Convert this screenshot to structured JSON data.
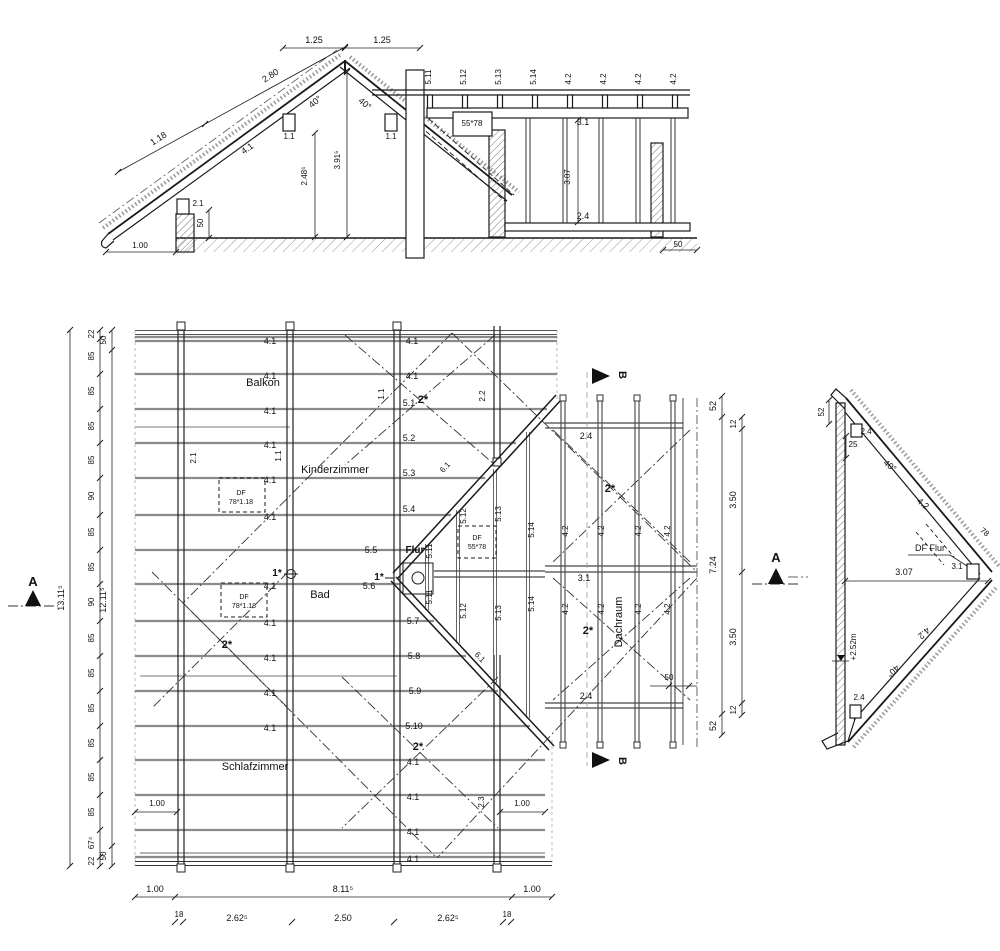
{
  "colors": {
    "line": "#1a1a1a",
    "rafter": "#8a8a8a",
    "dim": "#222",
    "light": "#c4c4c4",
    "marker": "#111"
  },
  "labels": [
    {
      "t": "1.25",
      "x": 314,
      "y": 43
    },
    {
      "t": "1.25",
      "x": 382,
      "y": 43
    },
    {
      "t": "2.80",
      "x": 272,
      "y": 78,
      "r": -33
    },
    {
      "t": "1.18",
      "x": 160,
      "y": 141,
      "r": -33
    },
    {
      "t": "4.1",
      "x": 249,
      "y": 151,
      "r": -36
    },
    {
      "t": "40°",
      "x": 317,
      "y": 104,
      "r": -40
    },
    {
      "t": "40°",
      "x": 363,
      "y": 106,
      "r": 40
    },
    {
      "t": "1.1",
      "x": 289,
      "y": 139,
      "s": 8
    },
    {
      "t": "1.1",
      "x": 391,
      "y": 139,
      "s": 8
    },
    {
      "t": "3.91⁵",
      "x": 340,
      "y": 160,
      "r": -90,
      "s": 8
    },
    {
      "t": "2.48⁵",
      "x": 307,
      "y": 176,
      "r": -90,
      "s": 8
    },
    {
      "t": "2.1",
      "x": 198,
      "y": 206,
      "s": 8
    },
    {
      "t": "50",
      "x": 203,
      "y": 223,
      "r": -90,
      "s": 8
    },
    {
      "t": "1.00",
      "x": 140,
      "y": 248,
      "s": 8
    },
    {
      "t": "5.11",
      "x": 431,
      "y": 77,
      "r": -90,
      "s": 8
    },
    {
      "t": "5.12",
      "x": 466,
      "y": 77,
      "r": -90,
      "s": 8
    },
    {
      "t": "5.13",
      "x": 501,
      "y": 77,
      "r": -90,
      "s": 8
    },
    {
      "t": "5.14",
      "x": 536,
      "y": 77,
      "r": -90,
      "s": 8
    },
    {
      "t": "4.2",
      "x": 571,
      "y": 79,
      "r": -90,
      "s": 8
    },
    {
      "t": "4.2",
      "x": 606,
      "y": 79,
      "r": -90,
      "s": 8
    },
    {
      "t": "4.2",
      "x": 641,
      "y": 79,
      "r": -90,
      "s": 8
    },
    {
      "t": "4.2",
      "x": 676,
      "y": 79,
      "r": -90,
      "s": 8
    },
    {
      "t": "55*78",
      "x": 472,
      "y": 126,
      "s": 8
    },
    {
      "t": "3.1",
      "x": 583,
      "y": 125,
      "s": 9
    },
    {
      "t": "3.07",
      "x": 570,
      "y": 177,
      "r": -90,
      "s": 8
    },
    {
      "t": "2.4",
      "x": 583,
      "y": 219,
      "s": 9
    },
    {
      "t": "50",
      "x": 678,
      "y": 247,
      "s": 8
    },
    {
      "t": "Balkon",
      "x": 263,
      "y": 386,
      "s": 11
    },
    {
      "t": "Kinderzimmer",
      "x": 335,
      "y": 473,
      "s": 11
    },
    {
      "t": "Bad",
      "x": 320,
      "y": 598,
      "s": 11
    },
    {
      "t": "Flur",
      "x": 415,
      "y": 553,
      "s": 10,
      "b": 1
    },
    {
      "t": "Schlafzimmer",
      "x": 255,
      "y": 770,
      "s": 11
    },
    {
      "t": "Dachraum",
      "x": 622,
      "y": 622,
      "r": -90,
      "s": 11
    },
    {
      "t": "4.1",
      "x": 270,
      "y": 344,
      "s": 9
    },
    {
      "t": "4.1",
      "x": 270,
      "y": 379,
      "s": 9
    },
    {
      "t": "4.1",
      "x": 270,
      "y": 414,
      "s": 9
    },
    {
      "t": "4.1",
      "x": 270,
      "y": 448,
      "s": 9
    },
    {
      "t": "4.1",
      "x": 270,
      "y": 483,
      "s": 9
    },
    {
      "t": "4.1",
      "x": 270,
      "y": 520,
      "s": 9
    },
    {
      "t": "4.1",
      "x": 270,
      "y": 589,
      "s": 9
    },
    {
      "t": "4.1",
      "x": 270,
      "y": 626,
      "s": 9
    },
    {
      "t": "4.1",
      "x": 270,
      "y": 661,
      "s": 9
    },
    {
      "t": "4.1",
      "x": 270,
      "y": 696,
      "s": 9
    },
    {
      "t": "4.1",
      "x": 270,
      "y": 731,
      "s": 9
    },
    {
      "t": "4.1",
      "x": 412,
      "y": 344,
      "s": 9
    },
    {
      "t": "4.1",
      "x": 412,
      "y": 379,
      "s": 9
    },
    {
      "t": "4.1",
      "x": 413,
      "y": 765,
      "s": 9
    },
    {
      "t": "4.1",
      "x": 413,
      "y": 800,
      "s": 9
    },
    {
      "t": "4.1",
      "x": 413,
      "y": 835,
      "s": 9
    },
    {
      "t": "4.1",
      "x": 413,
      "y": 862,
      "s": 9
    },
    {
      "t": "5.1",
      "x": 409,
      "y": 406,
      "s": 9
    },
    {
      "t": "5.2",
      "x": 409,
      "y": 441,
      "s": 9
    },
    {
      "t": "5.3",
      "x": 409,
      "y": 476,
      "s": 9
    },
    {
      "t": "5.4",
      "x": 409,
      "y": 512,
      "s": 9
    },
    {
      "t": "5.5",
      "x": 371,
      "y": 553,
      "s": 9
    },
    {
      "t": "5.6",
      "x": 369,
      "y": 589,
      "s": 9
    },
    {
      "t": "5.7",
      "x": 413,
      "y": 624,
      "s": 9
    },
    {
      "t": "5.8",
      "x": 414,
      "y": 659,
      "s": 9
    },
    {
      "t": "5.9",
      "x": 415,
      "y": 694,
      "s": 9
    },
    {
      "t": "5.10",
      "x": 414,
      "y": 729,
      "s": 9
    },
    {
      "t": "1*",
      "x": 277,
      "y": 576,
      "s": 10,
      "b": 1
    },
    {
      "t": "1*",
      "x": 379,
      "y": 580,
      "s": 10,
      "b": 1
    },
    {
      "t": "2*",
      "x": 423,
      "y": 403,
      "s": 11,
      "b": 1
    },
    {
      "t": "2*",
      "x": 227,
      "y": 648,
      "s": 11,
      "b": 1
    },
    {
      "t": "2*",
      "x": 418,
      "y": 750,
      "s": 11,
      "b": 1
    },
    {
      "t": "2*",
      "x": 610,
      "y": 492,
      "s": 11,
      "b": 1
    },
    {
      "t": "2*",
      "x": 588,
      "y": 634,
      "s": 11,
      "b": 1
    },
    {
      "t": "2.1",
      "x": 196,
      "y": 458,
      "r": -90,
      "s": 8
    },
    {
      "t": "1.1",
      "x": 281,
      "y": 456,
      "r": -90,
      "s": 8
    },
    {
      "t": "1.1",
      "x": 384,
      "y": 394,
      "r": -90,
      "s": 8
    },
    {
      "t": "2.2",
      "x": 485,
      "y": 396,
      "r": -90,
      "s": 8
    },
    {
      "t": "2.3",
      "x": 484,
      "y": 802,
      "r": -90,
      "s": 8
    },
    {
      "t": "6.1",
      "x": 447,
      "y": 469,
      "r": -48,
      "s": 8
    },
    {
      "t": "6.1",
      "x": 478,
      "y": 659,
      "r": 47,
      "s": 8
    },
    {
      "t": "5.11",
      "x": 432,
      "y": 551,
      "r": -90,
      "s": 8
    },
    {
      "t": "5.11",
      "x": 432,
      "y": 597,
      "r": -90,
      "s": 8
    },
    {
      "t": "5.12",
      "x": 466,
      "y": 516,
      "r": -90,
      "s": 8
    },
    {
      "t": "5.12",
      "x": 466,
      "y": 611,
      "r": -90,
      "s": 8
    },
    {
      "t": "5.13",
      "x": 501,
      "y": 514,
      "r": -90,
      "s": 8
    },
    {
      "t": "5.13",
      "x": 501,
      "y": 613,
      "r": -90,
      "s": 8
    },
    {
      "t": "5.14",
      "x": 534,
      "y": 530,
      "r": -90,
      "s": 8
    },
    {
      "t": "5.14",
      "x": 534,
      "y": 604,
      "r": -90,
      "s": 8
    },
    {
      "t": "DF",
      "x": 241,
      "y": 495,
      "s": 7
    },
    {
      "t": "78*1.18",
      "x": 241,
      "y": 504,
      "s": 7
    },
    {
      "t": "DF",
      "x": 244,
      "y": 599,
      "s": 7
    },
    {
      "t": "78*1.18",
      "x": 244,
      "y": 608,
      "s": 7
    },
    {
      "t": "DF",
      "x": 477,
      "y": 540,
      "s": 7
    },
    {
      "t": "55*78",
      "x": 477,
      "y": 549,
      "s": 7
    },
    {
      "t": "2.4",
      "x": 586,
      "y": 439,
      "s": 9
    },
    {
      "t": "3.1",
      "x": 584,
      "y": 581,
      "s": 9
    },
    {
      "t": "2.4",
      "x": 586,
      "y": 699,
      "s": 9
    },
    {
      "t": "4.2",
      "x": 568,
      "y": 531,
      "r": -90,
      "s": 8
    },
    {
      "t": "4.2",
      "x": 604,
      "y": 531,
      "r": -90,
      "s": 8
    },
    {
      "t": "4.2",
      "x": 641,
      "y": 531,
      "r": -90,
      "s": 8
    },
    {
      "t": "4.2",
      "x": 670,
      "y": 531,
      "r": -90,
      "s": 8
    },
    {
      "t": "4.2",
      "x": 568,
      "y": 609,
      "r": -90,
      "s": 8
    },
    {
      "t": "4.2",
      "x": 604,
      "y": 609,
      "r": -90,
      "s": 8
    },
    {
      "t": "4.2",
      "x": 641,
      "y": 609,
      "r": -90,
      "s": 8
    },
    {
      "t": "4.2",
      "x": 670,
      "y": 609,
      "r": -90,
      "s": 8
    },
    {
      "t": "50",
      "x": 669,
      "y": 680,
      "s": 8
    },
    {
      "t": "B",
      "x": 619,
      "y": 375,
      "r": 90,
      "s": 11,
      "b": 1
    },
    {
      "t": "B",
      "x": 619,
      "y": 761,
      "r": 90,
      "s": 11,
      "b": 1
    },
    {
      "t": "A",
      "x": 33,
      "y": 586,
      "s": 13,
      "b": 1
    },
    {
      "t": "A",
      "x": 776,
      "y": 562,
      "s": 13,
      "b": 1
    },
    {
      "t": "22",
      "x": 94,
      "y": 334,
      "r": -90,
      "s": 8
    },
    {
      "t": "85",
      "x": 94,
      "y": 356,
      "r": -90,
      "s": 8
    },
    {
      "t": "85",
      "x": 94,
      "y": 391,
      "r": -90,
      "s": 8
    },
    {
      "t": "85",
      "x": 94,
      "y": 426,
      "r": -90,
      "s": 8
    },
    {
      "t": "85",
      "x": 94,
      "y": 460,
      "r": -90,
      "s": 8
    },
    {
      "t": "90",
      "x": 94,
      "y": 496,
      "r": -90,
      "s": 8
    },
    {
      "t": "85",
      "x": 94,
      "y": 532,
      "r": -90,
      "s": 8
    },
    {
      "t": "85",
      "x": 94,
      "y": 567,
      "r": -90,
      "s": 8
    },
    {
      "t": "90",
      "x": 94,
      "y": 602,
      "r": -90,
      "s": 8
    },
    {
      "t": "85",
      "x": 94,
      "y": 638,
      "r": -90,
      "s": 8
    },
    {
      "t": "85",
      "x": 94,
      "y": 673,
      "r": -90,
      "s": 8
    },
    {
      "t": "85",
      "x": 94,
      "y": 708,
      "r": -90,
      "s": 8
    },
    {
      "t": "85",
      "x": 94,
      "y": 743,
      "r": -90,
      "s": 8
    },
    {
      "t": "85",
      "x": 94,
      "y": 777,
      "r": -90,
      "s": 8
    },
    {
      "t": "85",
      "x": 94,
      "y": 812,
      "r": -90,
      "s": 8
    },
    {
      "t": "67⁴",
      "x": 94,
      "y": 843,
      "r": -90,
      "s": 8
    },
    {
      "t": "22",
      "x": 94,
      "y": 861,
      "r": -90,
      "s": 8
    },
    {
      "t": "13.11⁵",
      "x": 64,
      "y": 598,
      "r": -90,
      "s": 9
    },
    {
      "t": "50",
      "x": 106,
      "y": 340,
      "r": -90,
      "s": 8
    },
    {
      "t": "12.11⁵",
      "x": 106,
      "y": 600,
      "r": -90,
      "s": 9
    },
    {
      "t": "50",
      "x": 106,
      "y": 856,
      "r": -90,
      "s": 8
    },
    {
      "t": "1.00",
      "x": 155,
      "y": 892,
      "s": 9
    },
    {
      "t": "8.11⁵",
      "x": 343,
      "y": 892,
      "s": 9
    },
    {
      "t": "1.00",
      "x": 532,
      "y": 892,
      "s": 9
    },
    {
      "t": "18",
      "x": 179,
      "y": 917,
      "s": 8
    },
    {
      "t": "2.62⁵",
      "x": 237,
      "y": 921,
      "s": 9
    },
    {
      "t": "2.50",
      "x": 343,
      "y": 921,
      "s": 9
    },
    {
      "t": "2.62⁵",
      "x": 448,
      "y": 921,
      "s": 9
    },
    {
      "t": "18",
      "x": 507,
      "y": 917,
      "s": 8
    },
    {
      "t": "1.00",
      "x": 157,
      "y": 806,
      "s": 8
    },
    {
      "t": "1.00",
      "x": 522,
      "y": 806,
      "s": 8
    },
    {
      "t": "52",
      "x": 716,
      "y": 406,
      "r": -90,
      "s": 9
    },
    {
      "t": "7.24",
      "x": 716,
      "y": 565,
      "r": -90,
      "s": 9
    },
    {
      "t": "52",
      "x": 716,
      "y": 726,
      "r": -90,
      "s": 9
    },
    {
      "t": "12",
      "x": 736,
      "y": 424,
      "r": -90,
      "s": 8
    },
    {
      "t": "3.50",
      "x": 736,
      "y": 500,
      "r": -90,
      "s": 9
    },
    {
      "t": "3.50",
      "x": 736,
      "y": 637,
      "r": -90,
      "s": 9
    },
    {
      "t": "12",
      "x": 736,
      "y": 710,
      "r": -90,
      "s": 8
    },
    {
      "t": "52",
      "x": 824,
      "y": 412,
      "r": -90,
      "s": 8
    },
    {
      "t": "2.4",
      "x": 866,
      "y": 434,
      "s": 8
    },
    {
      "t": "25",
      "x": 853,
      "y": 447,
      "s": 8
    },
    {
      "t": "40°",
      "x": 888,
      "y": 468,
      "r": 40,
      "s": 9
    },
    {
      "t": "4.2",
      "x": 921,
      "y": 506,
      "r": 40,
      "s": 9
    },
    {
      "t": "78",
      "x": 983,
      "y": 534,
      "r": 40,
      "s": 8
    },
    {
      "t": "DF Flur",
      "x": 930,
      "y": 551,
      "s": 9
    },
    {
      "t": "3.07",
      "x": 904,
      "y": 575,
      "s": 9
    },
    {
      "t": "3.1",
      "x": 957,
      "y": 569,
      "s": 8
    },
    {
      "t": "+2.52m",
      "x": 856,
      "y": 647,
      "r": -90,
      "s": 8
    },
    {
      "t": "4.2",
      "x": 922,
      "y": 631,
      "r": 138,
      "s": 9
    },
    {
      "t": "40°",
      "x": 891,
      "y": 669,
      "r": 138,
      "s": 9
    },
    {
      "t": "2.4",
      "x": 859,
      "y": 700,
      "s": 8
    }
  ]
}
